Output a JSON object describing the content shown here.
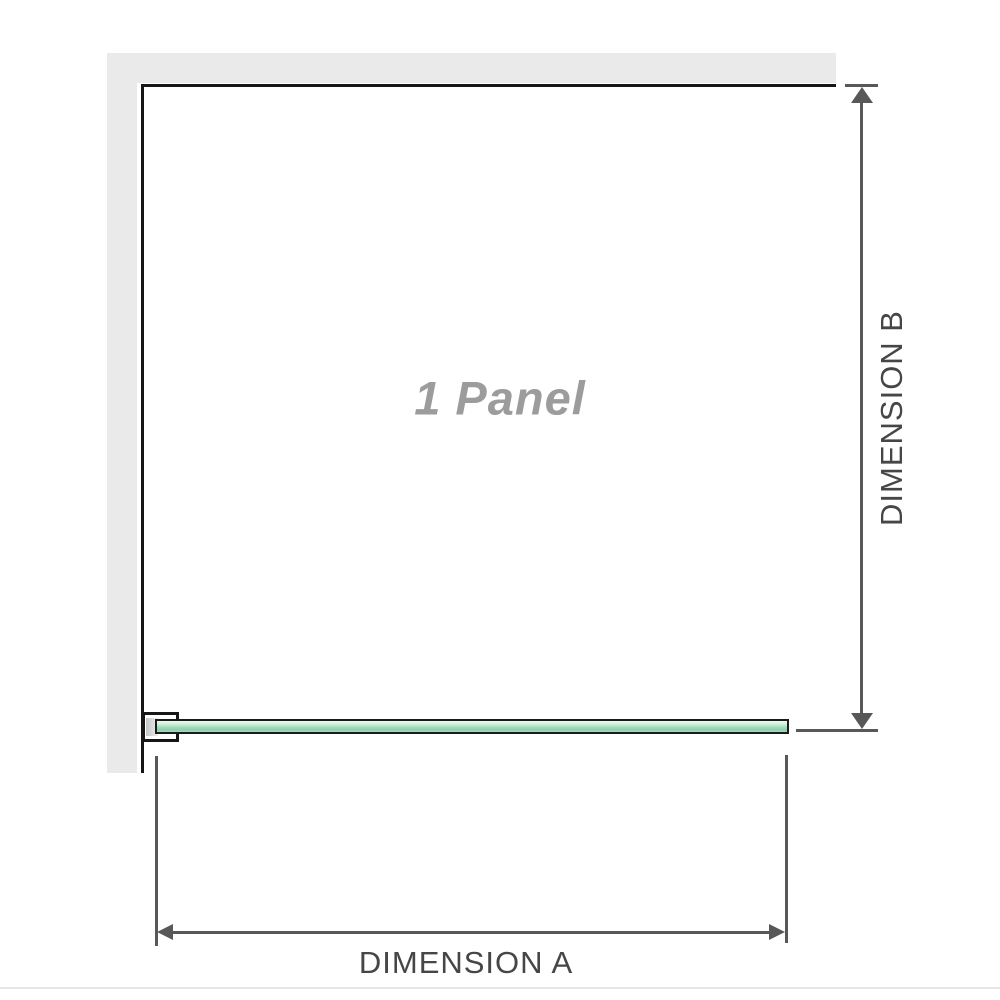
{
  "diagram": {
    "title": "1 Panel",
    "dimensions": {
      "horizontal": {
        "label": "DIMENSION A"
      },
      "vertical": {
        "label": "DIMENSION B"
      }
    },
    "colors": {
      "wall": "#eaeaea",
      "outline": "#161616",
      "dimension": "#58585a",
      "label_text": "#464646",
      "panel_text": "#9c9c9c",
      "glass_border": "#1b1b1b",
      "glass_light": "#f0f9f4",
      "glass_mid": "#9fd8b8",
      "glass_dark": "#8fd0ad",
      "separator": "#e5e5e2"
    }
  }
}
